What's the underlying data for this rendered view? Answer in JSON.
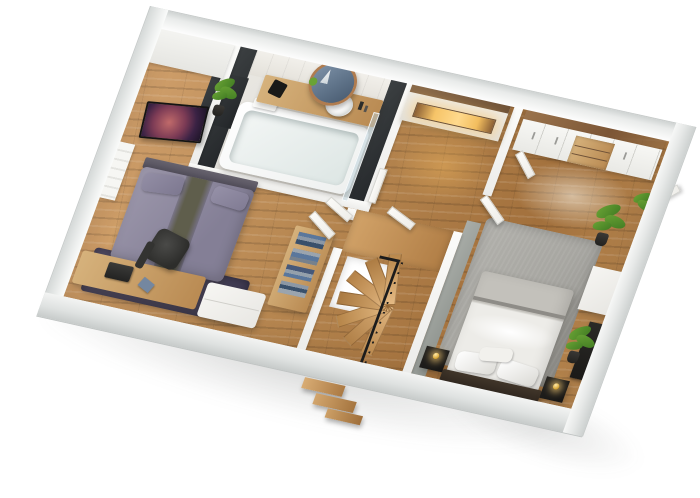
{
  "meta": {
    "type": "3d-floor-plan-render",
    "view": "axonometric cutaway (dollhouse) of one apartment level on white background",
    "visible_text": "none"
  },
  "palette": {
    "wall_top": "#f4f5f4",
    "wall_inner": "#ececea",
    "gray_wall": "#a9ada8",
    "charcoal": "#3c4042",
    "charcoal_dk": "#24272a",
    "wood_hi": "#cf9f6b",
    "wood_mid": "#b5854f",
    "wood_dk": "#a2703c",
    "bath_floor": "#eae8e3",
    "desk_wood": "#d6b27c",
    "stair_wood": "#d2a369",
    "lavender": "#9c97ab",
    "lavender_dk": "#847f96",
    "olive_runner": "#5f5e4c",
    "rug_dark": "#49445a",
    "rug_gray": "#a7a6a1",
    "bed2_white": "#edece8",
    "bed2_gray": "#c3c1bb",
    "frame_dark": "#30271f",
    "nightstand_black": "#171615",
    "lamp_gold": "#d9a93c",
    "plant": "#6aa335",
    "plant_dk": "#3f7a22",
    "pot": "#23221f",
    "mirror_wood": "#b07c4f",
    "mirror_glass": "#5f7389",
    "niche_glow": "#ffd98c",
    "tv_nebula_core": "#c06a6a",
    "tv_nebula_mid": "#7c3b55",
    "tv_nebula_dark": "#1c1426",
    "door": "#efeeea",
    "rail_black": "#1c1c1c"
  },
  "rooms": [
    {
      "id": "bathroom",
      "label": "bathroom (top-left)",
      "objects": [
        "white-tile-wall",
        "charcoal-accent-walls",
        "round-wood-mirror",
        "wood-vanity-counter",
        "round-vessel-sink",
        "faucet",
        "bathtub",
        "glass-shower-screen",
        "toiletries",
        "small-plant",
        "white-towel-unit",
        "door-ajar"
      ]
    },
    {
      "id": "bedroom-left",
      "label": "bedroom with desk (left)",
      "objects": [
        "double-bed-lavender-bedding",
        "olive-bed-runner",
        "dark-headboard",
        "dark-purple-rug",
        "wall-tv-nebula-image",
        "plant-in-wall-niche",
        "white-closet-panel",
        "radiator-panel",
        "wood-desk",
        "laptop",
        "blue-notebook",
        "dark-office-chair",
        "white-storage-bench",
        "shelf-with-folded-clothes",
        "door-ajar"
      ]
    },
    {
      "id": "hallway",
      "label": "hallway (top-center)",
      "objects": [
        "sideboard-with-amber-lit-niche",
        "wood-trim",
        "white-doors-ajar",
        "wood-flooring",
        "warm-light-pool"
      ]
    },
    {
      "id": "stairwell",
      "label": "stairwell (center-bottom)",
      "objects": [
        "wood-winder-treads",
        "upper-landing",
        "floor-opening",
        "black-metal-balustrade",
        "newel-post",
        "exterior-steps-below-slab"
      ]
    },
    {
      "id": "bedroom-right",
      "label": "master bedroom (right)",
      "objects": [
        "wardrobe-white-doors",
        "wood-beam-top",
        "wood-drawer-unit",
        "open-wardrobe-doors",
        "double-bed-gray-white-bedding",
        "dark-bed-frame",
        "black-nightstands",
        "gold-sphere-lamps",
        "gray-area-rug",
        "gray-accent-wall",
        "potted-plants",
        "white-side-table",
        "dark-tv-panel",
        "ceiling-light-pool"
      ]
    }
  ]
}
